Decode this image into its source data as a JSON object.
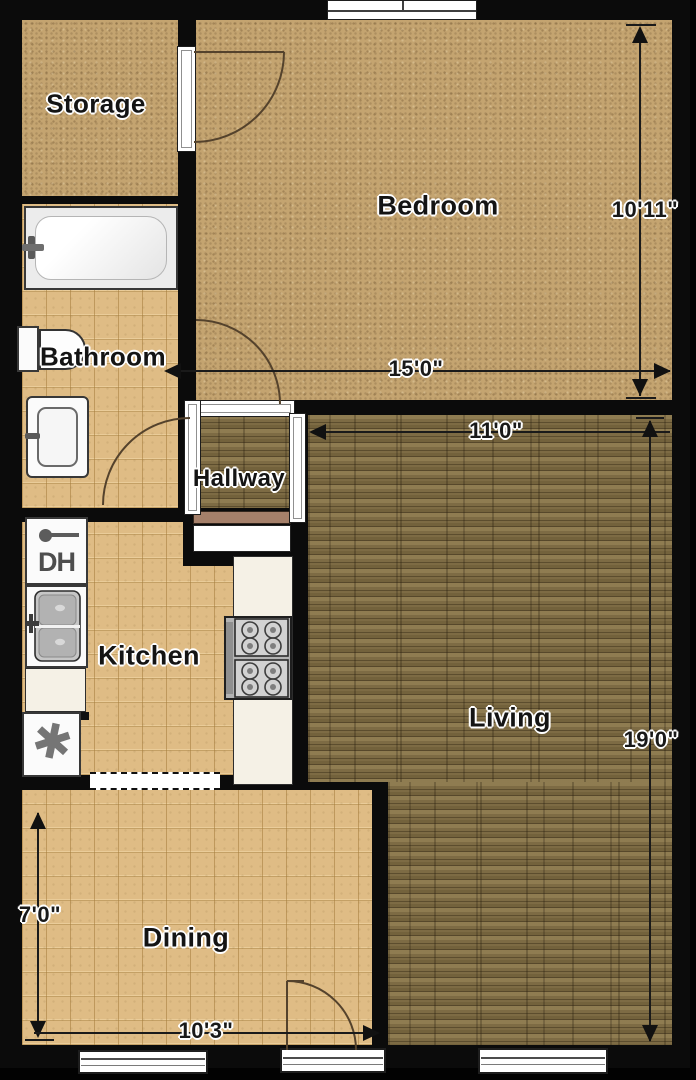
{
  "title": "Apartment floor plan",
  "rooms": {
    "storage": {
      "label": "Storage"
    },
    "bedroom": {
      "label": "Bedroom"
    },
    "bathroom": {
      "label": "Bathroom"
    },
    "hallway": {
      "label": "Hallway"
    },
    "kitchen": {
      "label": "Kitchen"
    },
    "living": {
      "label": "Living"
    },
    "dining": {
      "label": "Dining"
    }
  },
  "dimensions": {
    "bedroom_depth": {
      "label": "10'11\"",
      "orientation": "vertical"
    },
    "bedroom_width": {
      "label": "15'0\"",
      "orientation": "horizontal"
    },
    "living_width": {
      "label": "11'0\"",
      "orientation": "horizontal"
    },
    "living_depth": {
      "label": "19'0\"",
      "orientation": "vertical"
    },
    "dining_depth": {
      "label": "7'0\"",
      "orientation": "vertical"
    },
    "dining_width": {
      "label": "10'3\"",
      "orientation": "horizontal"
    }
  },
  "fixtures": {
    "dishwasher_symbol": "DH",
    "fan_symbol": "✱"
  },
  "colors": {
    "wall": "#0b0b0b",
    "speckle_floor": "#c4a470",
    "tile_floor": "#dfbc85",
    "wood_floor": "#7d6b44",
    "fixture_white": "#fbfbfb",
    "counter_cream": "#f5f1e6",
    "shelf_brown": "#a5806a"
  }
}
